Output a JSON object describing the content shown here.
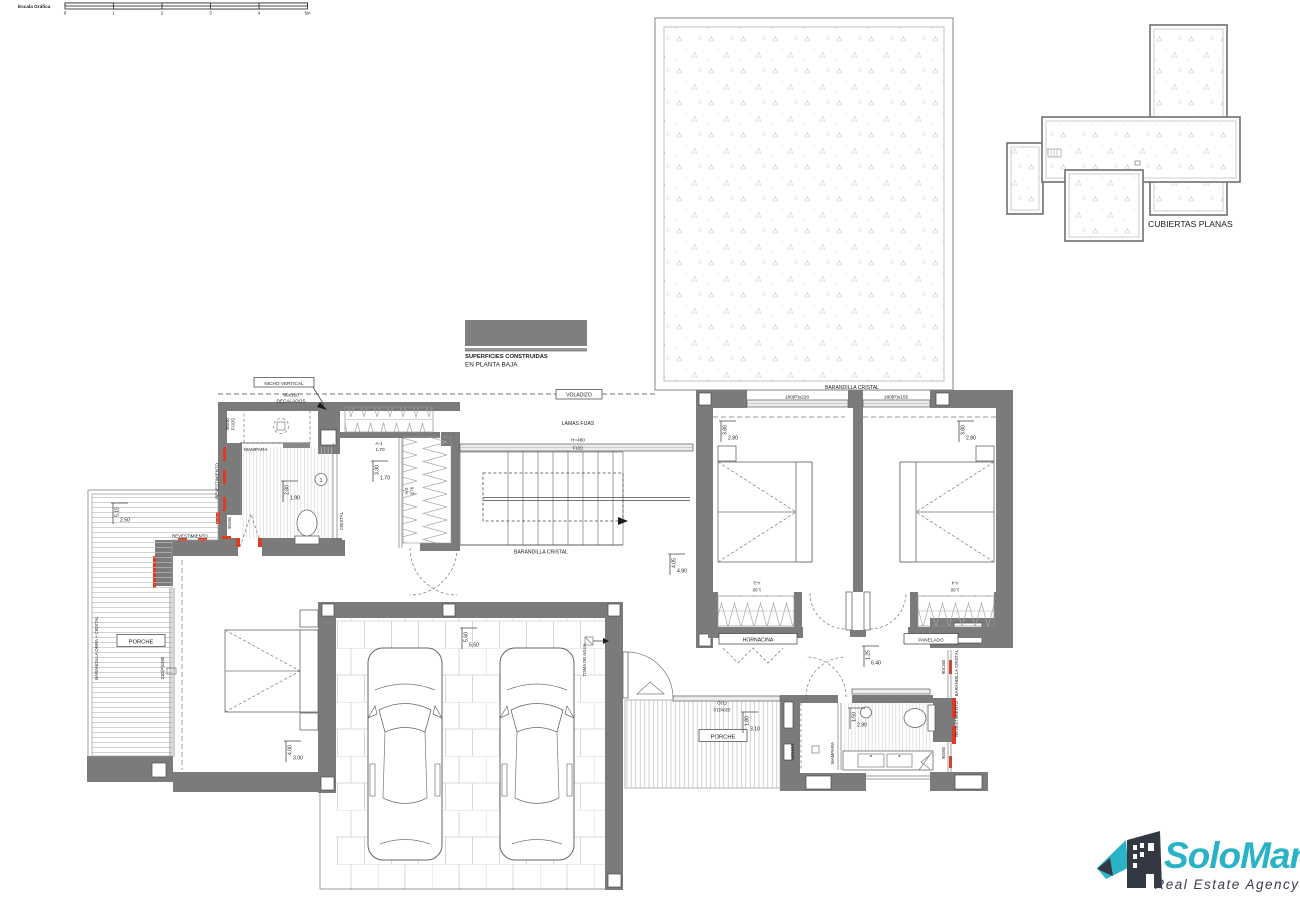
{
  "colors": {
    "wall_gray": "#7b7b7b",
    "accent_red": "#e03a20",
    "legend_gray": "#7f7f7f",
    "logo_teal": "#2ab3c6",
    "logo_dark": "#343843"
  },
  "scale_bar": {
    "label": "Escala Gráfica",
    "ticks": [
      "0",
      "1",
      "2",
      "3",
      "4",
      "5m"
    ]
  },
  "legend": {
    "line1": "SUPERFICIES CONSTRUIDAS",
    "line2": "EN PLANTA BAJA"
  },
  "roof_plan": {
    "label": "CUBIERTAS PLANAS"
  },
  "callouts": {
    "voladizo": "VOLADIZO",
    "lamas_fijas": "LAMAS FIJAS",
    "h480": "H=480",
    "fijo": "FIJO",
    "nicho_vertical": "NICHO VERTICAL",
    "decalados_size": "90x160",
    "decalados": "DECALADOS",
    "fijos_size": "90x90",
    "fijos_label": "FIJOS",
    "mampara": "MAMPARA",
    "revestimiento": "REVESTIMIENTO",
    "size_90x60": "90x60",
    "size_90x160": "90x160",
    "cristal": "CRISTAL",
    "barandilla_cristal": "BARANDILLA CRISTAL",
    "barandilla_obra_cristal": "BARANDILLA OBRA + CRISTAL",
    "porche": "PORCHE",
    "hornacina": "HORNACINA",
    "panelado": "PANELADO",
    "toma_de_agua": "TOMA DE AGUA",
    "nichos": "NICHOS",
    "window_230x350": "230(P)x350",
    "window_180x220": "180(P)x220",
    "window_180x155": "180(P)x155",
    "fijo_small": "FIJO",
    "fijo_small_size": "220x210"
  },
  "fixtures": {
    "a1": "A-1",
    "a1_size": "1.70",
    "closet_a2": "A-2",
    "closet_a2_size": "2.70",
    "a2": "A-2",
    "a2_size": "1.60",
    "a4": "A-4",
    "a4_size": "1.60",
    "bath1_number": "1",
    "bath2_number": "2"
  },
  "dimensions": {
    "bath1": {
      "v": "2.80",
      "h": "1.90"
    },
    "stair": {
      "v": "3.30",
      "h": "1.70"
    },
    "hall": {
      "v": "4.05",
      "h": "4.90"
    },
    "hall2": {
      "v": "1.25",
      "h": "6.40"
    },
    "bedroom2": {
      "v": "3.80",
      "h": "2.80"
    },
    "bedroom3": {
      "v": "3.80",
      "h": "2.80"
    },
    "porch_left": {
      "v": "5.15",
      "h": "2.50"
    },
    "master": {
      "v": "4.00",
      "h": "3.00"
    },
    "garage": {
      "v": "5.60",
      "h": "5.50"
    },
    "porch_center": {
      "v": "1.80",
      "h": "3.10"
    },
    "bath2": {
      "v": "1.50",
      "h": "2.90"
    }
  },
  "logo": {
    "name": "SoloMar",
    "tagline": "Real Estate Agency"
  }
}
